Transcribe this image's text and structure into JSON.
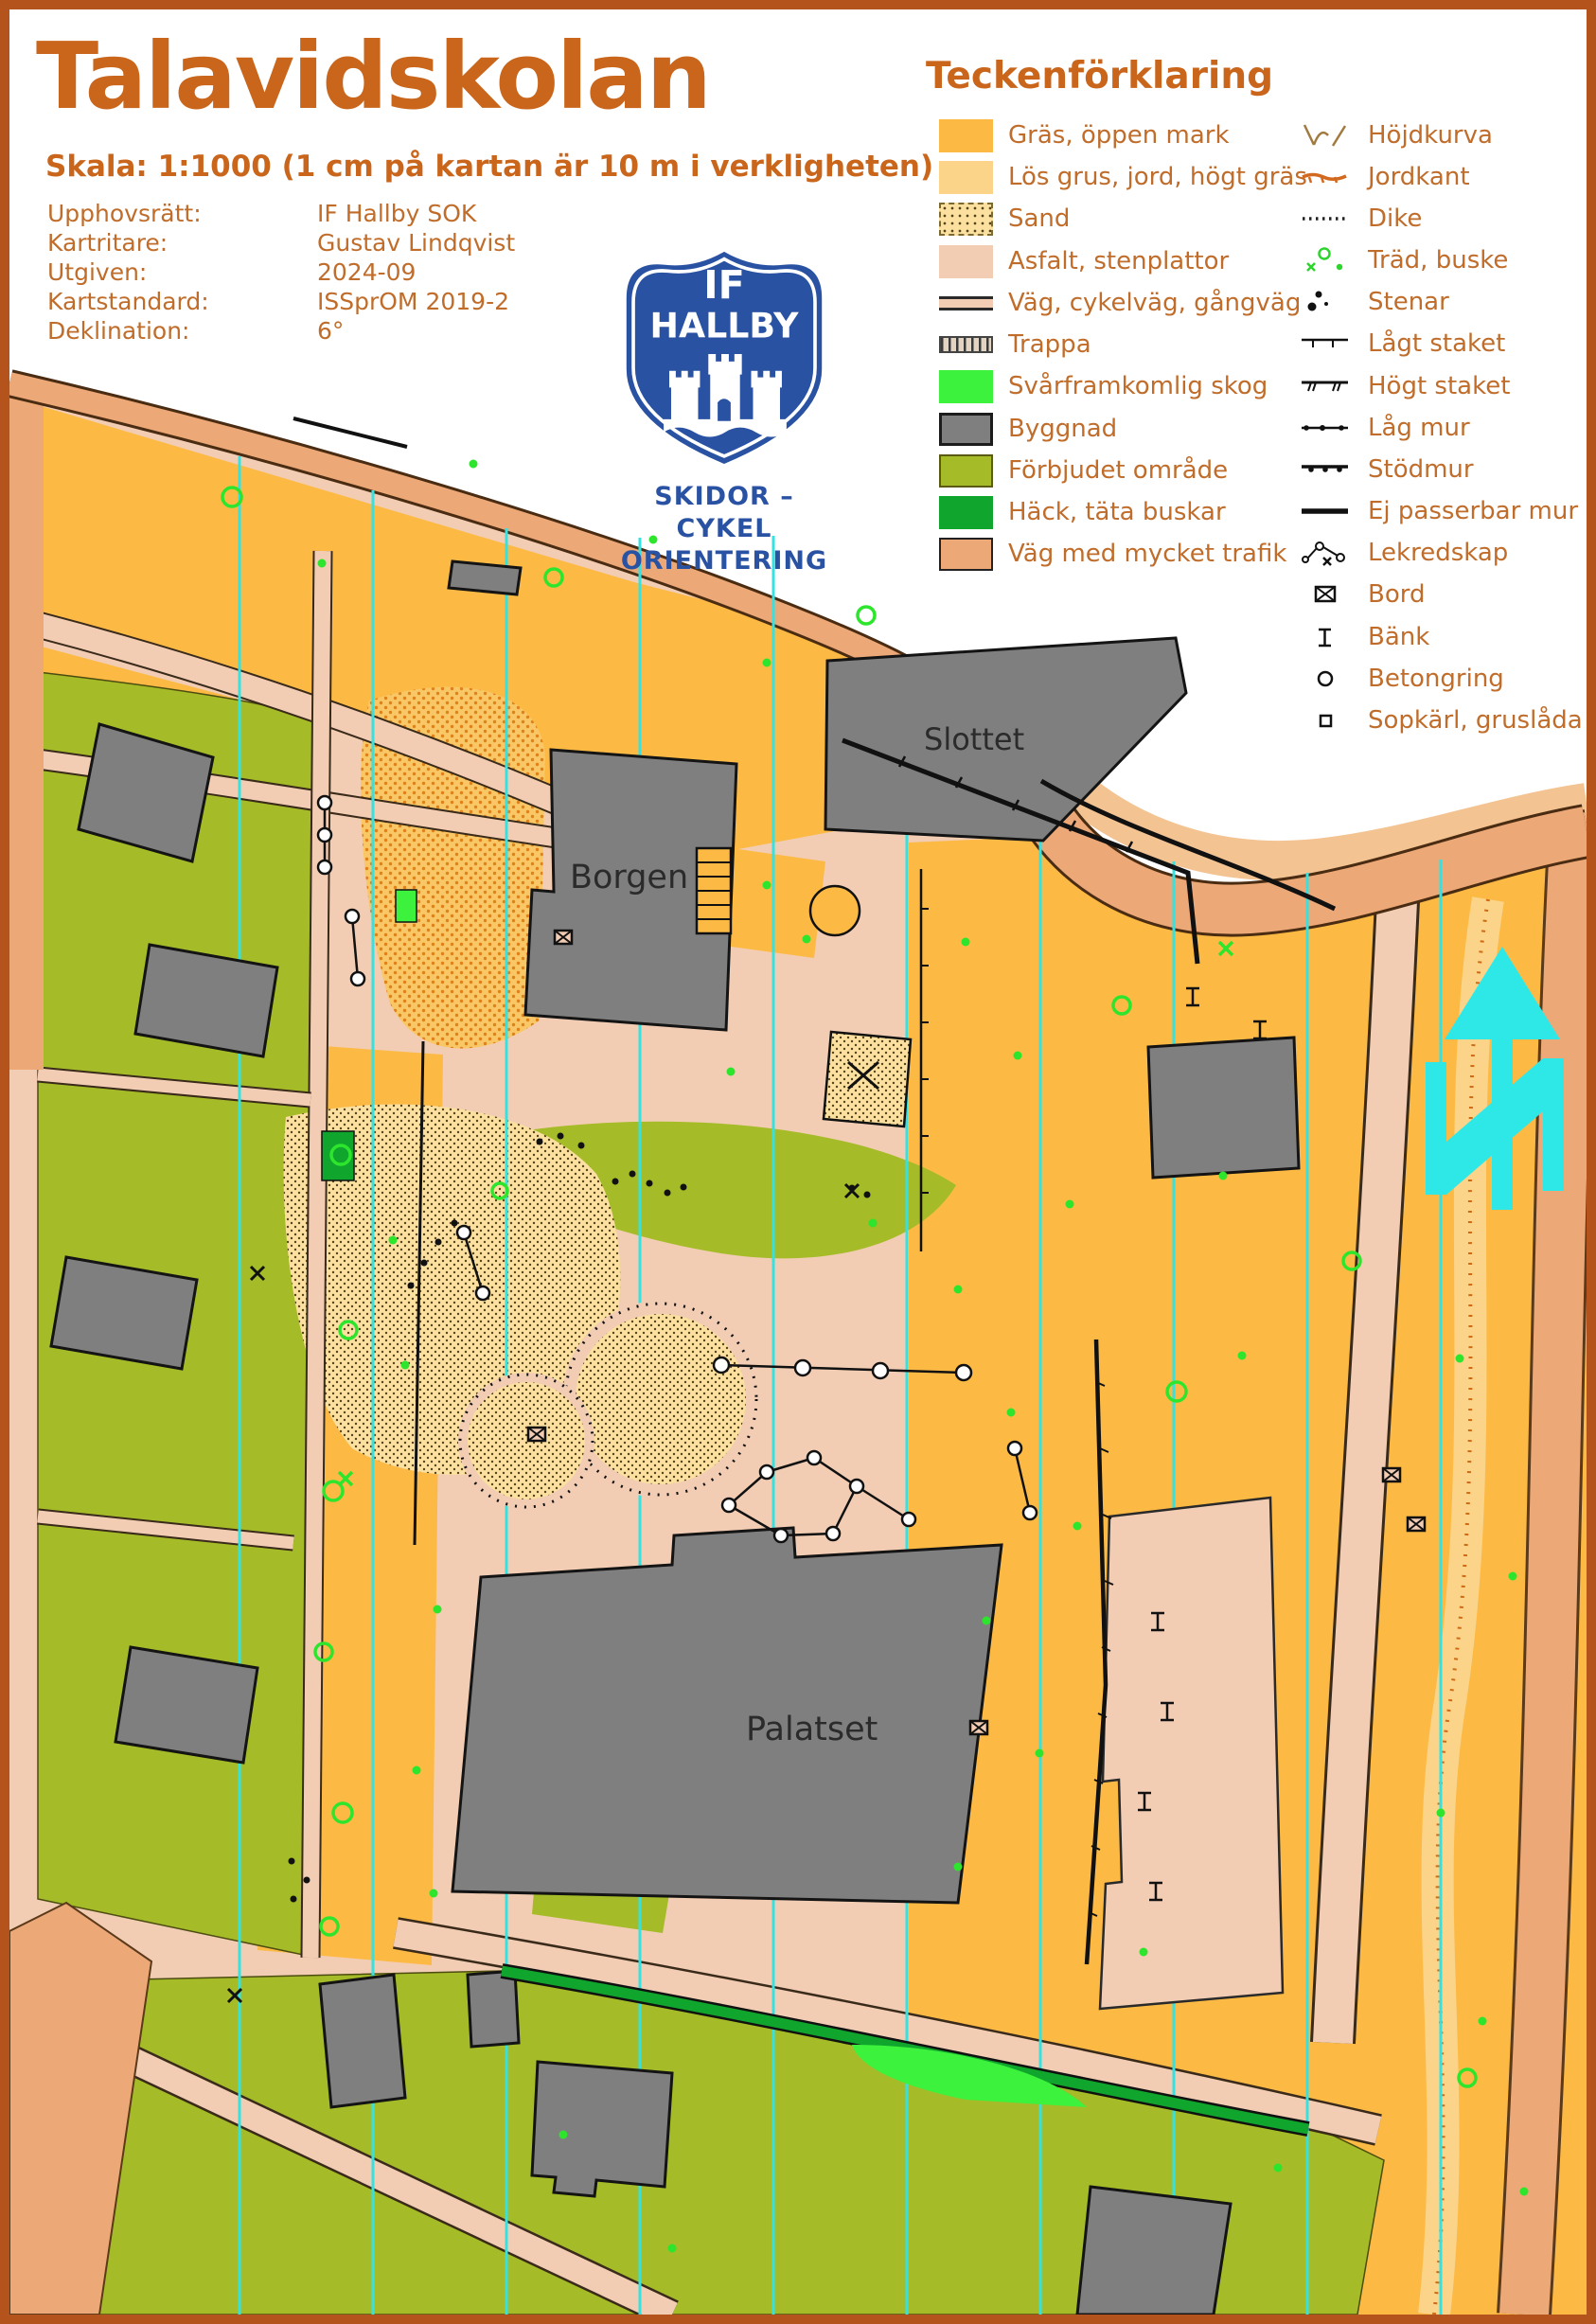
{
  "palette": {
    "accent_text": "#c9661c",
    "meta_text": "#c06d2b",
    "frame": "#b4541c",
    "logo_blue": "#2a52a3",
    "asfalt": "#f2cdb4",
    "grass": "#fcba45",
    "loose_ground": "#fbd489",
    "traffic_road": "#eda877",
    "traffic_road_light": "#f3c392",
    "forbidden": "#a5bb27",
    "thicket": "#3cf23c",
    "hedge": "#10a52c",
    "building": "#7f7f7f",
    "north_line_cyan": "#35e2e2"
  },
  "header": {
    "title": "Talavidskolan",
    "scale": "Skala: 1:1000 (1 cm på kartan är 10 m i verkligheten)",
    "meta": [
      {
        "label": "Upphovsrätt:",
        "value": "IF Hallby SOK"
      },
      {
        "label": "Kartritare:",
        "value": "Gustav Lindqvist"
      },
      {
        "label": "Utgiven:",
        "value": "2024-09"
      },
      {
        "label": "Kartstandard:",
        "value": "ISSprOM 2019-2"
      },
      {
        "label": "Deklination:",
        "value": "6°"
      }
    ]
  },
  "logo": {
    "top": "IF",
    "name": "HALLBY",
    "sub1": "SKIDOR – CYKEL",
    "sub2": "ORIENTERING"
  },
  "legend": {
    "title": "Teckenförklaring",
    "left": [
      {
        "label": "Gräs, öppen mark"
      },
      {
        "label": "Lös grus, jord, högt gräs"
      },
      {
        "label": "Sand"
      },
      {
        "label": "Asfalt, stenplattor"
      },
      {
        "label": "Väg, cykelväg, gångväg"
      },
      {
        "label": "Trappa"
      },
      {
        "label": "Svårframkomlig skog"
      },
      {
        "label": "Byggnad"
      },
      {
        "label": "Förbjudet område"
      },
      {
        "label": "Häck, täta buskar"
      },
      {
        "label": "Väg med mycket trafik"
      }
    ],
    "right": [
      {
        "label": "Höjdkurva"
      },
      {
        "label": "Jordkant"
      },
      {
        "label": "Dike"
      },
      {
        "label": "Träd, buske"
      },
      {
        "label": "Stenar"
      },
      {
        "label": "Lågt staket"
      },
      {
        "label": "Högt staket"
      },
      {
        "label": "Låg mur"
      },
      {
        "label": "Stödmur"
      },
      {
        "label": "Ej passerbar mur"
      },
      {
        "label": "Lekredskap"
      },
      {
        "label": "Bord"
      },
      {
        "label": "Bänk"
      },
      {
        "label": "Betongring"
      },
      {
        "label": "Sopkärl, gruslåda"
      }
    ]
  },
  "map": {
    "labels": {
      "slottet": "Slottet",
      "borgen": "Borgen",
      "palatset": "Palatset"
    }
  }
}
